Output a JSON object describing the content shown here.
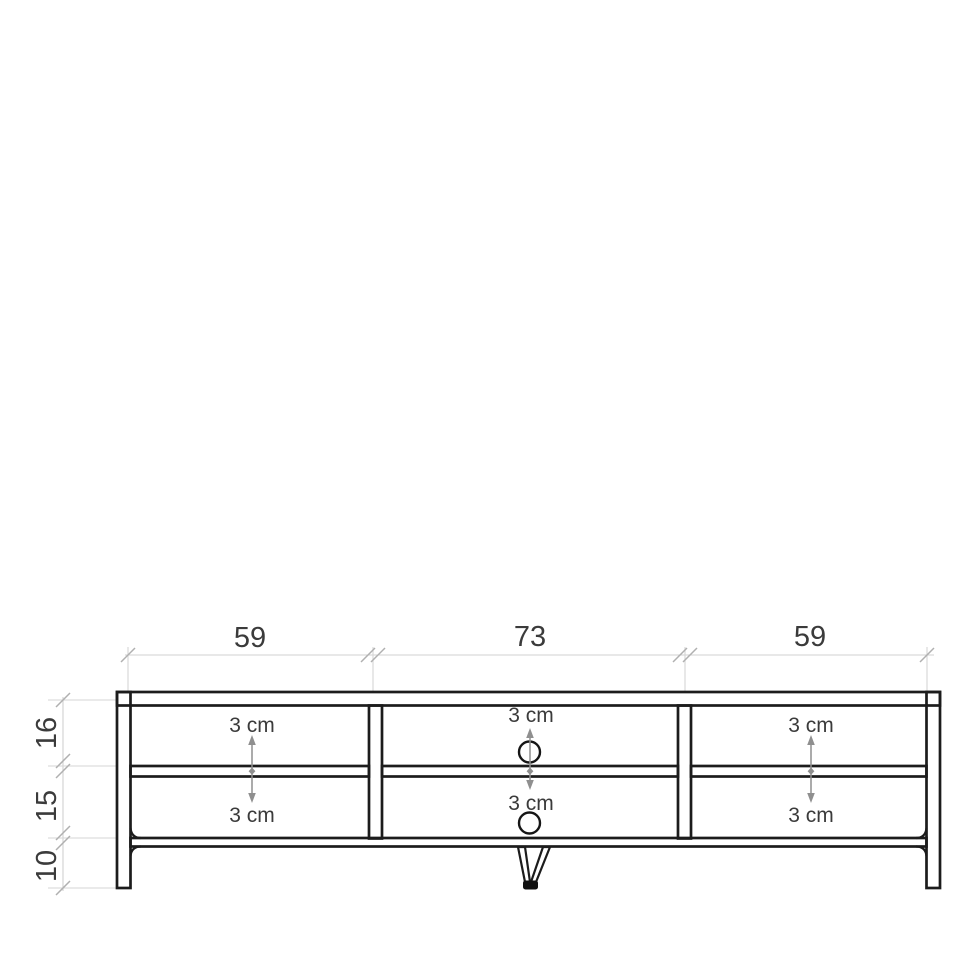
{
  "diagram": {
    "object": "tv-lowboard-dimension-drawing",
    "unit": "cm",
    "width_sections_cm": [
      59,
      73,
      59
    ],
    "height_sections_cm": [
      16,
      15,
      10
    ],
    "labels": {
      "top": [
        "59",
        "73",
        "59"
      ],
      "left": [
        "16",
        "15",
        "10"
      ],
      "clearances": [
        "3 cm",
        "3 cm",
        "3 cm",
        "3 cm",
        "3 cm",
        "3 cm"
      ]
    },
    "colors": {
      "outline": "#1c1c1c",
      "dimension_line": "#d0d0d0",
      "tick": "#b0b0b0",
      "arrow": "#8f8f8f",
      "text": "#3b3b3b",
      "background": "#ffffff"
    }
  }
}
